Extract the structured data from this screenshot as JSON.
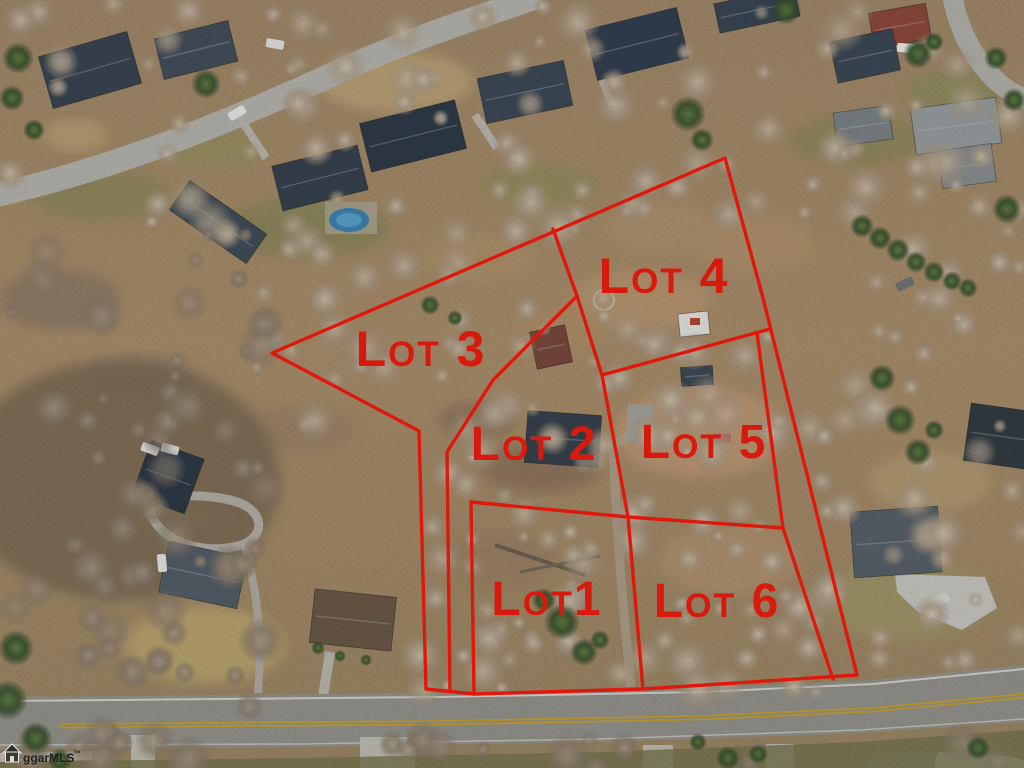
{
  "canvas": {
    "width": 1024,
    "height": 768
  },
  "lots": [
    {
      "label": "Lot 3",
      "label_x": 421,
      "label_y": 366,
      "font_size": 50
    },
    {
      "label": "Lot 4",
      "label_x": 664,
      "label_y": 293,
      "font_size": 50
    },
    {
      "label": "Lot 2",
      "label_x": 534,
      "label_y": 460,
      "font_size": 48
    },
    {
      "label": "Lot 5",
      "label_x": 704,
      "label_y": 458,
      "font_size": 48
    },
    {
      "label": "Lot1",
      "label_x": 547,
      "label_y": 615,
      "font_size": 48
    },
    {
      "label": "Lot 6",
      "label_x": 717,
      "label_y": 617,
      "font_size": 48
    }
  ],
  "overlay": {
    "line_color": "#e0180c",
    "label_color": "#d81a0e",
    "line_width": 3.4,
    "outer_boundary": [
      [
        272,
        353
      ],
      [
        725,
        158
      ],
      [
        763,
        298
      ],
      [
        857,
        675
      ],
      [
        643,
        689
      ],
      [
        474,
        694
      ],
      [
        426,
        689
      ],
      [
        419,
        431
      ]
    ],
    "inner_lines": [
      {
        "name": "lot3-lot4-divider",
        "points": [
          [
            553,
            229
          ],
          [
            577,
            296
          ],
          [
            602,
            375
          ]
        ]
      },
      {
        "name": "lot2-lot5-divider",
        "points": [
          [
            602,
            375
          ],
          [
            628,
            517
          ],
          [
            643,
            689
          ]
        ]
      },
      {
        "name": "lot4-lot5-divider",
        "points": [
          [
            602,
            375
          ],
          [
            770,
            329
          ]
        ]
      },
      {
        "name": "lot2-lot3-west-divider",
        "points": [
          [
            577,
            296
          ],
          [
            493,
            380
          ],
          [
            447,
            452
          ],
          [
            450,
            691
          ]
        ]
      },
      {
        "name": "lot5-lot6-east-line",
        "points": [
          [
            757,
            333
          ],
          [
            783,
            528
          ],
          [
            833,
            679
          ]
        ]
      },
      {
        "name": "lot1-lot6-north-line",
        "points": [
          [
            471,
            502
          ],
          [
            628,
            517
          ],
          [
            783,
            528
          ]
        ]
      },
      {
        "name": "lot1-west-line",
        "points": [
          [
            471,
            502
          ],
          [
            474,
            694
          ]
        ]
      }
    ]
  },
  "watermark": {
    "icon": "house-icon",
    "text": "ggarMLS",
    "trademark": "™"
  }
}
